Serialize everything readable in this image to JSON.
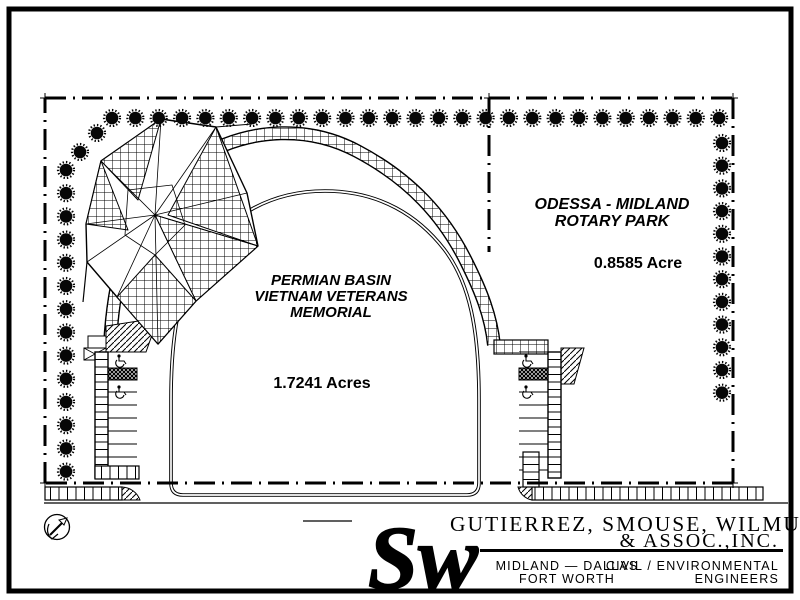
{
  "drawing": {
    "colors": {
      "ink": "#000000",
      "paper": "#ffffff"
    },
    "site_labels": {
      "memorial_name_line1": "PERMIAN BASIN",
      "memorial_name_line2": "VIETNAM VETERANS",
      "memorial_name_line3": "MEMORIAL",
      "memorial_area": "1.7241 Acres",
      "park_name_line1": "ODESSA - MIDLAND",
      "park_name_line2": "ROTARY PARK",
      "park_area": "0.8585 Acre"
    }
  },
  "title_block": {
    "firm_name_line1": "GUTIERREZ, SMOUSE, WILMUT",
    "firm_name_line2": "& ASSOC.,INC.",
    "offices_line1": "MIDLAND — DALLAS",
    "offices_line2": "FORT WORTH",
    "discipline_line1": "CIVIL / ENVIRONMENTAL",
    "discipline_line2": "ENGINEERS",
    "logo_monogram": "Sw"
  }
}
